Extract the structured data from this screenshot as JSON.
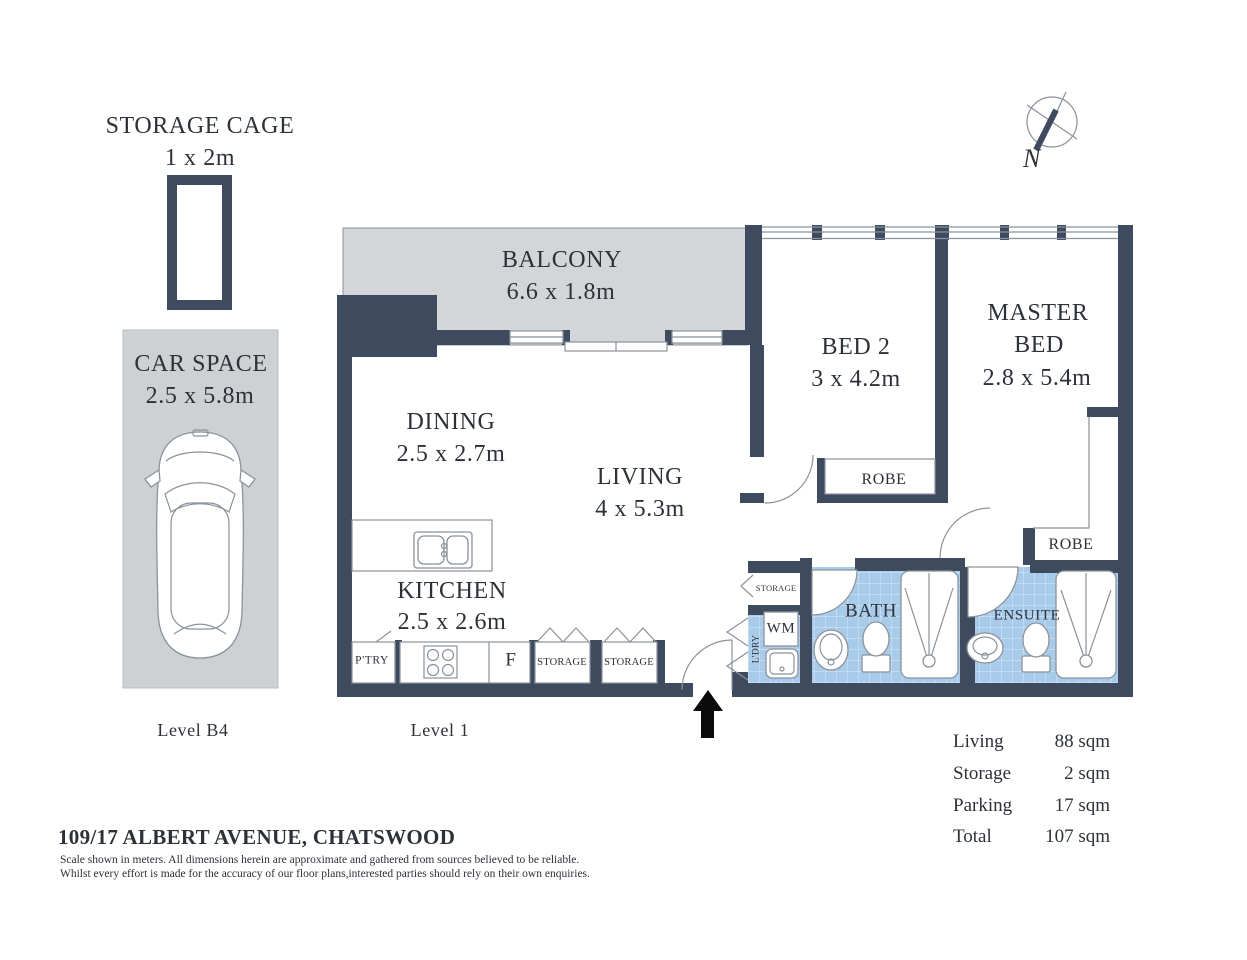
{
  "colors": {
    "wall": "#3e4b5e",
    "tile": "#a9cbea",
    "tile_line": "#d9e8f8",
    "floor_gray": "#d3d6d8",
    "car_gray": "#cdd1d3",
    "outline": "#8b929a",
    "text": "#2d3138",
    "arrow": "#0b0b0c"
  },
  "compass": {
    "north_label": "N"
  },
  "storage_cage": {
    "title": "STORAGE CAGE",
    "dims": "1 x 2m"
  },
  "car_space": {
    "title": "CAR SPACE",
    "dims": "2.5 x 5.8m"
  },
  "levels": {
    "basement": "Level B4",
    "floor": "Level 1"
  },
  "rooms": {
    "balcony": {
      "name": "BALCONY",
      "dims": "6.6 x 1.8m"
    },
    "dining": {
      "name": "DINING",
      "dims": "2.5 x 2.7m"
    },
    "living": {
      "name": "LIVING",
      "dims": "4 x 5.3m"
    },
    "kitchen": {
      "name": "KITCHEN",
      "dims": "2.5 x 2.6m"
    },
    "bed2": {
      "name": "BED 2",
      "dims": "3 x 4.2m"
    },
    "master_bed": {
      "line1": "MASTER",
      "line2": "BED",
      "dims": "2.8 x 5.4m"
    },
    "bath": {
      "name": "BATH"
    },
    "ensuite": {
      "name": "ENSUITE"
    }
  },
  "features": {
    "robe_bed2": "ROBE",
    "robe_master": "ROBE",
    "pantry": "P'TRY",
    "fridge": "F",
    "storage_kitchen_1": "STORAGE",
    "storage_kitchen_2": "STORAGE",
    "storage_hall": "STORAGE",
    "laundry": "L'DRY",
    "washing_machine": "WM"
  },
  "area_summary": {
    "rows": [
      {
        "label": "Living",
        "value": "88 sqm"
      },
      {
        "label": "Storage",
        "value": "2 sqm"
      },
      {
        "label": "Parking",
        "value": "17 sqm"
      },
      {
        "label": "Total",
        "value": "107 sqm"
      }
    ]
  },
  "footer": {
    "address": "109/17 ALBERT AVENUE, CHATSWOOD",
    "disclaimer_line1": "Scale shown in meters. All dimensions herein are approximate and gathered from sources believed to be  reliable.",
    "disclaimer_line2": "Whilst every effort is made for the accuracy of our floor plans,interested parties should rely on their own enquiries."
  }
}
